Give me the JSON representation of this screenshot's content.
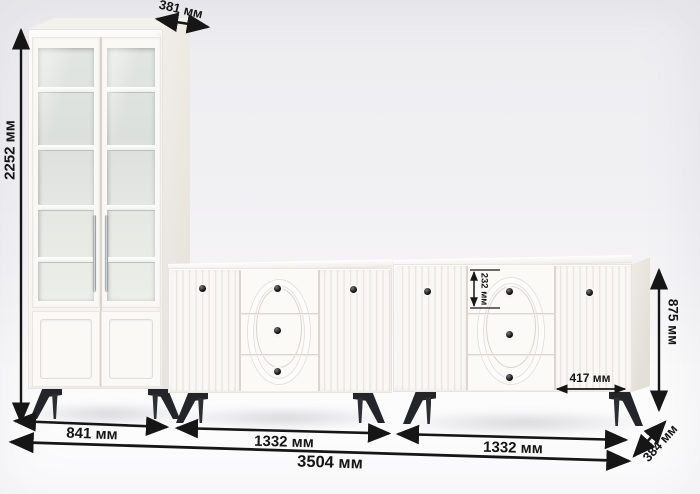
{
  "diagram": {
    "kind": "furniture-dimension-diagram",
    "units": "мм"
  },
  "dimensions": {
    "cabinet_depth": "381 мм",
    "cabinet_height": "2252 мм",
    "cabinet_width": "841 мм",
    "sideboard1_width": "1332 мм",
    "sideboard2_width": "1332 мм",
    "total_width": "3504 мм",
    "sideboard_height": "875 мм",
    "sideboard_depth": "384 мм",
    "drawer_height": "232 мм",
    "right_door_width": "417 мм"
  },
  "colors": {
    "annotation": "#161616",
    "furniture_body": "#faf8f5",
    "glass": "#e0e4e0",
    "knob": "#141414",
    "legs": "#26272a",
    "background": "#f1f0f3"
  }
}
